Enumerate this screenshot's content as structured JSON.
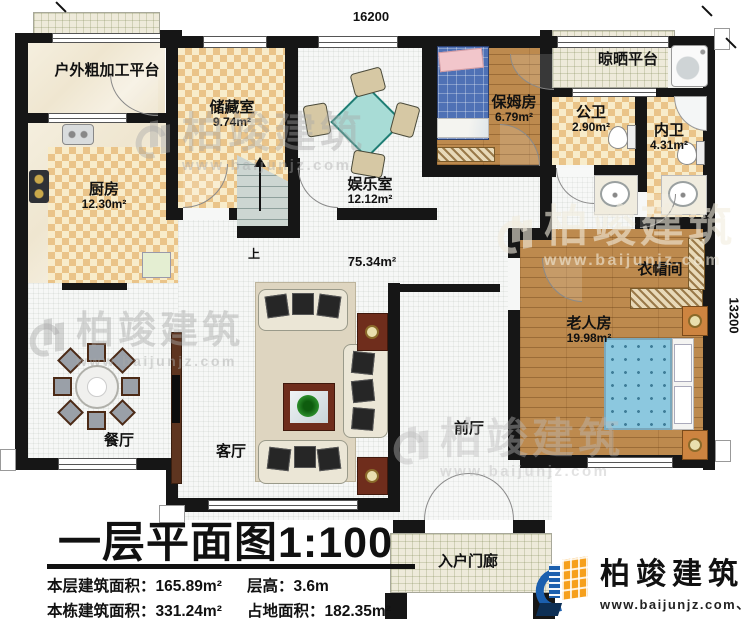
{
  "dimensions": {
    "top": "16200",
    "right": "13200"
  },
  "rooms": {
    "outdoor_platform": {
      "label": "户外粗加工平台"
    },
    "storage": {
      "label": "储藏室",
      "area": "9.74m²"
    },
    "kitchen": {
      "label": "厨房",
      "area": "12.30m²"
    },
    "entertainment": {
      "label": "娱乐室",
      "area": "12.12m²"
    },
    "nanny": {
      "label": "保姆房",
      "area": "6.79m²"
    },
    "drying_platform": {
      "label": "晾晒平台"
    },
    "public_bath": {
      "label": "公卫",
      "area": "2.90m²"
    },
    "inner_bath": {
      "label": "内卫",
      "area": "4.31m²"
    },
    "cloakroom": {
      "label": "衣帽间"
    },
    "elder_room": {
      "label": "老人房",
      "area": "19.98m²"
    },
    "dining": {
      "label": "餐厅"
    },
    "living": {
      "label": "客厅"
    },
    "front_hall": {
      "label": "前厅"
    },
    "entry_porch": {
      "label": "入户门廊"
    },
    "hall": {
      "area": "75.34m²"
    },
    "stairs": {
      "up_label": "上"
    }
  },
  "title_block": {
    "title": "一层平面图1:100",
    "stats": [
      "本层建筑面积：165.89m²",
      "层高：3.6m",
      "本栋建筑面积：331.24m²",
      "占地面积：182.35m²"
    ]
  },
  "logo": {
    "name": "柏竣建筑",
    "url": "www.baijunjz.com、"
  },
  "watermark": {
    "name": "柏竣建筑",
    "url": "www.baijunjz.com"
  }
}
